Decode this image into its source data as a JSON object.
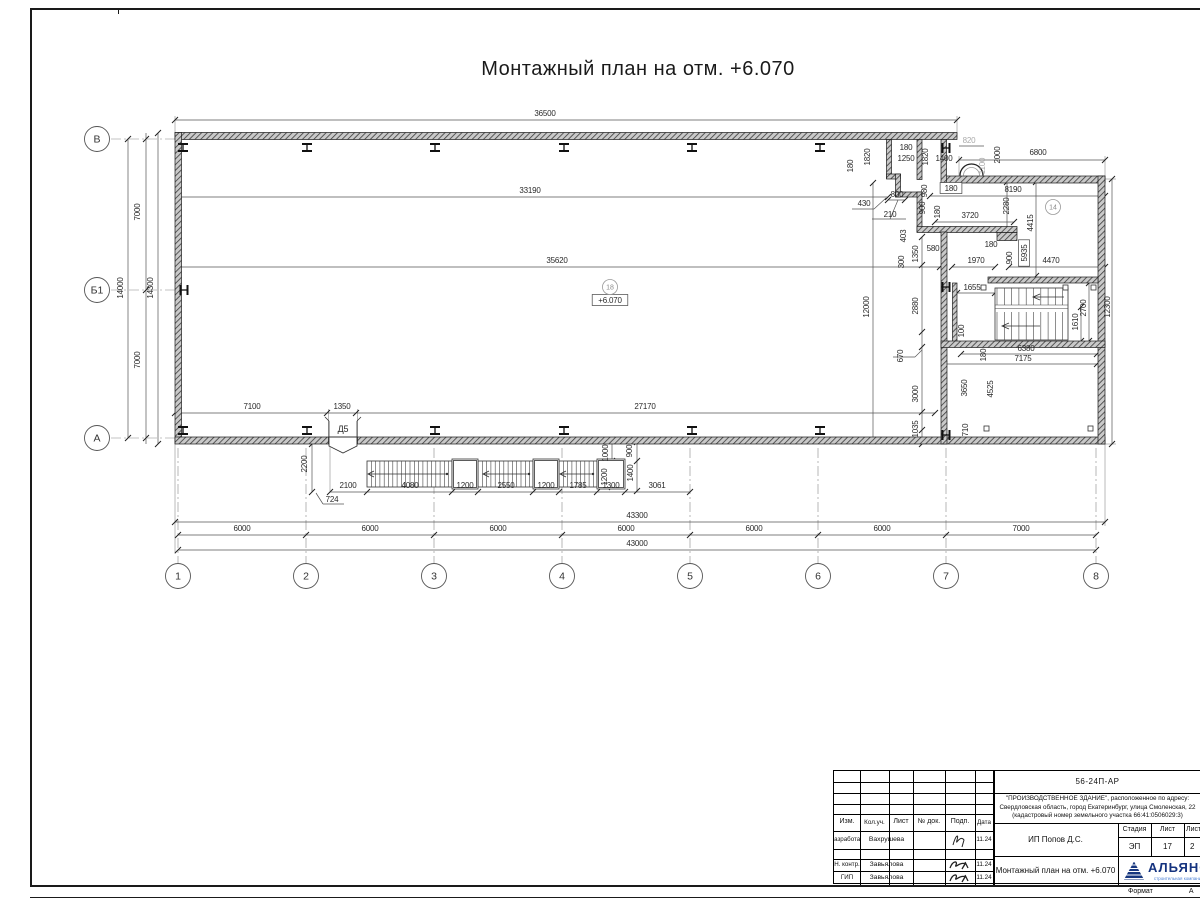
{
  "sheet": {
    "title": "Монтажный план на отм. +6.070",
    "format_label": "Формат",
    "format_value": "А"
  },
  "titleblock": {
    "doc_code": "56-24П-АР",
    "address_line1": "\"ПРОИЗВОДСТВЕННОЕ ЗДАНИЕ\", расположенное по адресу:",
    "address_line2": "Свердловская область, город Екатеринбург, улица Смоленская, 22",
    "address_line3": "(кадастровый номер земельного участка 66:41:0506029:3)",
    "client": "ИП Попов Д.С.",
    "drawing_name": "Монтажный план на отм. +6.070",
    "stage_label": "Стадия",
    "stage_value": "ЭП",
    "sheet_label": "Лист",
    "sheet_value": "17",
    "sheets_label": "Листов",
    "sheets_value": "2",
    "company_name": "АЛЬЯНС",
    "company_sub": "строительная компания",
    "cols": [
      "Изм.",
      "Кол.уч.",
      "Лист",
      "№ док.",
      "Подп.",
      "Дата"
    ],
    "row1": {
      "role": "Разработал",
      "name": "Вахрушева",
      "date": "11.24"
    },
    "row2": {
      "role": "Н. контр.",
      "name": "Завьялова",
      "date": "11.24"
    },
    "row3": {
      "role": "ГИП",
      "name": "Завьялова",
      "date": "11.24"
    }
  },
  "plan": {
    "elevation_mark": "+6.070",
    "door_tag": "Д5",
    "axis_bubbles": [
      {
        "t": "1",
        "x": 178,
        "y": 576
      },
      {
        "t": "2",
        "x": 306,
        "y": 576
      },
      {
        "t": "3",
        "x": 434,
        "y": 576
      },
      {
        "t": "4",
        "x": 562,
        "y": 576
      },
      {
        "t": "5",
        "x": 690,
        "y": 576
      },
      {
        "t": "6",
        "x": 818,
        "y": 576
      },
      {
        "t": "7",
        "x": 946,
        "y": 576
      },
      {
        "t": "8",
        "x": 1096,
        "y": 576
      },
      {
        "t": "В",
        "x": 97,
        "y": 139
      },
      {
        "t": "Б1",
        "x": 97,
        "y": 290
      },
      {
        "t": "А",
        "x": 97,
        "y": 438
      }
    ],
    "room_bubbles": [
      {
        "t": "18",
        "x": 610,
        "y": 287
      },
      {
        "t": "14",
        "x": 1053,
        "y": 207
      }
    ],
    "texts": [
      {
        "t": "36500",
        "x": 545,
        "y": 116
      },
      {
        "t": "6800",
        "x": 1038,
        "y": 155
      },
      {
        "t": "33190",
        "x": 530,
        "y": 193
      },
      {
        "t": "35620",
        "x": 557,
        "y": 263
      },
      {
        "t": "8190",
        "x": 1013,
        "y": 192
      },
      {
        "t": "3720",
        "x": 970,
        "y": 218
      },
      {
        "t": "2280",
        "x": 1009,
        "y": 206,
        "r": 1
      },
      {
        "t": "4415",
        "x": 1033,
        "y": 223,
        "r": 1
      },
      {
        "t": "5935",
        "x": 1027,
        "y": 253,
        "r": 1,
        "b": 1
      },
      {
        "t": "900",
        "x": 1012,
        "y": 258,
        "r": 1
      },
      {
        "t": "180",
        "x": 991,
        "y": 247
      },
      {
        "t": "1970",
        "x": 976,
        "y": 263
      },
      {
        "t": "4470",
        "x": 1051,
        "y": 263
      },
      {
        "t": "1655",
        "x": 972,
        "y": 290
      },
      {
        "t": "2700",
        "x": 1086,
        "y": 308,
        "r": 1
      },
      {
        "t": "1610",
        "x": 1078,
        "y": 322,
        "r": 1
      },
      {
        "t": "12300",
        "x": 1110,
        "y": 307,
        "r": 1
      },
      {
        "t": "12000",
        "x": 869,
        "y": 307,
        "r": 1
      },
      {
        "t": "2880",
        "x": 918,
        "y": 306,
        "r": 1
      },
      {
        "t": "670",
        "x": 903,
        "y": 356,
        "r": 1
      },
      {
        "t": "3000",
        "x": 918,
        "y": 394,
        "r": 1
      },
      {
        "t": "1035",
        "x": 918,
        "y": 429,
        "r": 1
      },
      {
        "t": "300",
        "x": 904,
        "y": 262,
        "r": 1
      },
      {
        "t": "1350",
        "x": 918,
        "y": 254,
        "r": 1
      },
      {
        "t": "580",
        "x": 933,
        "y": 251
      },
      {
        "t": "403",
        "x": 906,
        "y": 236,
        "r": 1
      },
      {
        "t": "800",
        "x": 897,
        "y": 197
      },
      {
        "t": "430",
        "x": 864,
        "y": 206
      },
      {
        "t": "210",
        "x": 890,
        "y": 217
      },
      {
        "t": "980",
        "x": 927,
        "y": 191,
        "r": 1
      },
      {
        "t": "900",
        "x": 925,
        "y": 208,
        "r": 1
      },
      {
        "t": "180",
        "x": 940,
        "y": 212,
        "r": 1
      },
      {
        "t": "180",
        "x": 853,
        "y": 166,
        "r": 1
      },
      {
        "t": "1820",
        "x": 870,
        "y": 157,
        "r": 1
      },
      {
        "t": "180",
        "x": 906,
        "y": 150
      },
      {
        "t": "1250",
        "x": 906,
        "y": 161
      },
      {
        "t": "1820",
        "x": 928,
        "y": 157,
        "r": 1
      },
      {
        "t": "1400",
        "x": 944,
        "y": 161
      },
      {
        "t": "820",
        "x": 969,
        "y": 143,
        "g": 1
      },
      {
        "t": "1100",
        "x": 985,
        "y": 166,
        "r": 1,
        "g": 1
      },
      {
        "t": "2000",
        "x": 1000,
        "y": 155,
        "r": 1
      },
      {
        "t": "180",
        "x": 951,
        "y": 191,
        "b": 1
      },
      {
        "t": "100",
        "x": 964,
        "y": 331,
        "r": 1
      },
      {
        "t": "180",
        "x": 986,
        "y": 355,
        "r": 1
      },
      {
        "t": "6380",
        "x": 1026,
        "y": 351
      },
      {
        "t": "7175",
        "x": 1023,
        "y": 361
      },
      {
        "t": "3650",
        "x": 967,
        "y": 388,
        "r": 1
      },
      {
        "t": "4525",
        "x": 993,
        "y": 389,
        "r": 1
      },
      {
        "t": "710",
        "x": 968,
        "y": 430,
        "r": 1
      },
      {
        "t": "7100",
        "x": 252,
        "y": 409
      },
      {
        "t": "1350",
        "x": 342,
        "y": 409
      },
      {
        "t": "27170",
        "x": 645,
        "y": 409
      },
      {
        "t": "2200",
        "x": 307,
        "y": 464,
        "r": 1
      },
      {
        "t": "2100",
        "x": 348,
        "y": 488
      },
      {
        "t": "4080",
        "x": 410,
        "y": 488
      },
      {
        "t": "1200",
        "x": 465,
        "y": 488
      },
      {
        "t": "2550",
        "x": 506,
        "y": 488
      },
      {
        "t": "1200",
        "x": 546,
        "y": 488
      },
      {
        "t": "1785",
        "x": 578,
        "y": 488
      },
      {
        "t": "1300",
        "x": 611,
        "y": 488
      },
      {
        "t": "3061",
        "x": 657,
        "y": 488
      },
      {
        "t": "1000",
        "x": 608,
        "y": 453,
        "r": 1
      },
      {
        "t": "900",
        "x": 632,
        "y": 451,
        "r": 1
      },
      {
        "t": "1200",
        "x": 607,
        "y": 477,
        "r": 1
      },
      {
        "t": "1400",
        "x": 633,
        "y": 473,
        "r": 1
      },
      {
        "t": "724",
        "x": 332,
        "y": 502
      },
      {
        "t": "43300",
        "x": 637,
        "y": 518
      },
      {
        "t": "6000",
        "x": 242,
        "y": 531
      },
      {
        "t": "6000",
        "x": 370,
        "y": 531
      },
      {
        "t": "6000",
        "x": 498,
        "y": 531
      },
      {
        "t": "6000",
        "x": 626,
        "y": 531
      },
      {
        "t": "6000",
        "x": 754,
        "y": 531
      },
      {
        "t": "6000",
        "x": 882,
        "y": 531
      },
      {
        "t": "7000",
        "x": 1021,
        "y": 531
      },
      {
        "t": "43000",
        "x": 637,
        "y": 546
      },
      {
        "t": "7000",
        "x": 140,
        "y": 212,
        "r": 1
      },
      {
        "t": "7000",
        "x": 140,
        "y": 360,
        "r": 1
      },
      {
        "t": "14000",
        "x": 123,
        "y": 288,
        "r": 1
      },
      {
        "t": "14300",
        "x": 153,
        "y": 288,
        "r": 1
      },
      {
        "t": "+6.070",
        "x": 610,
        "y": 303,
        "b": 1
      },
      {
        "t": "Д5",
        "x": 343,
        "y": 432,
        "s": 9
      }
    ]
  }
}
